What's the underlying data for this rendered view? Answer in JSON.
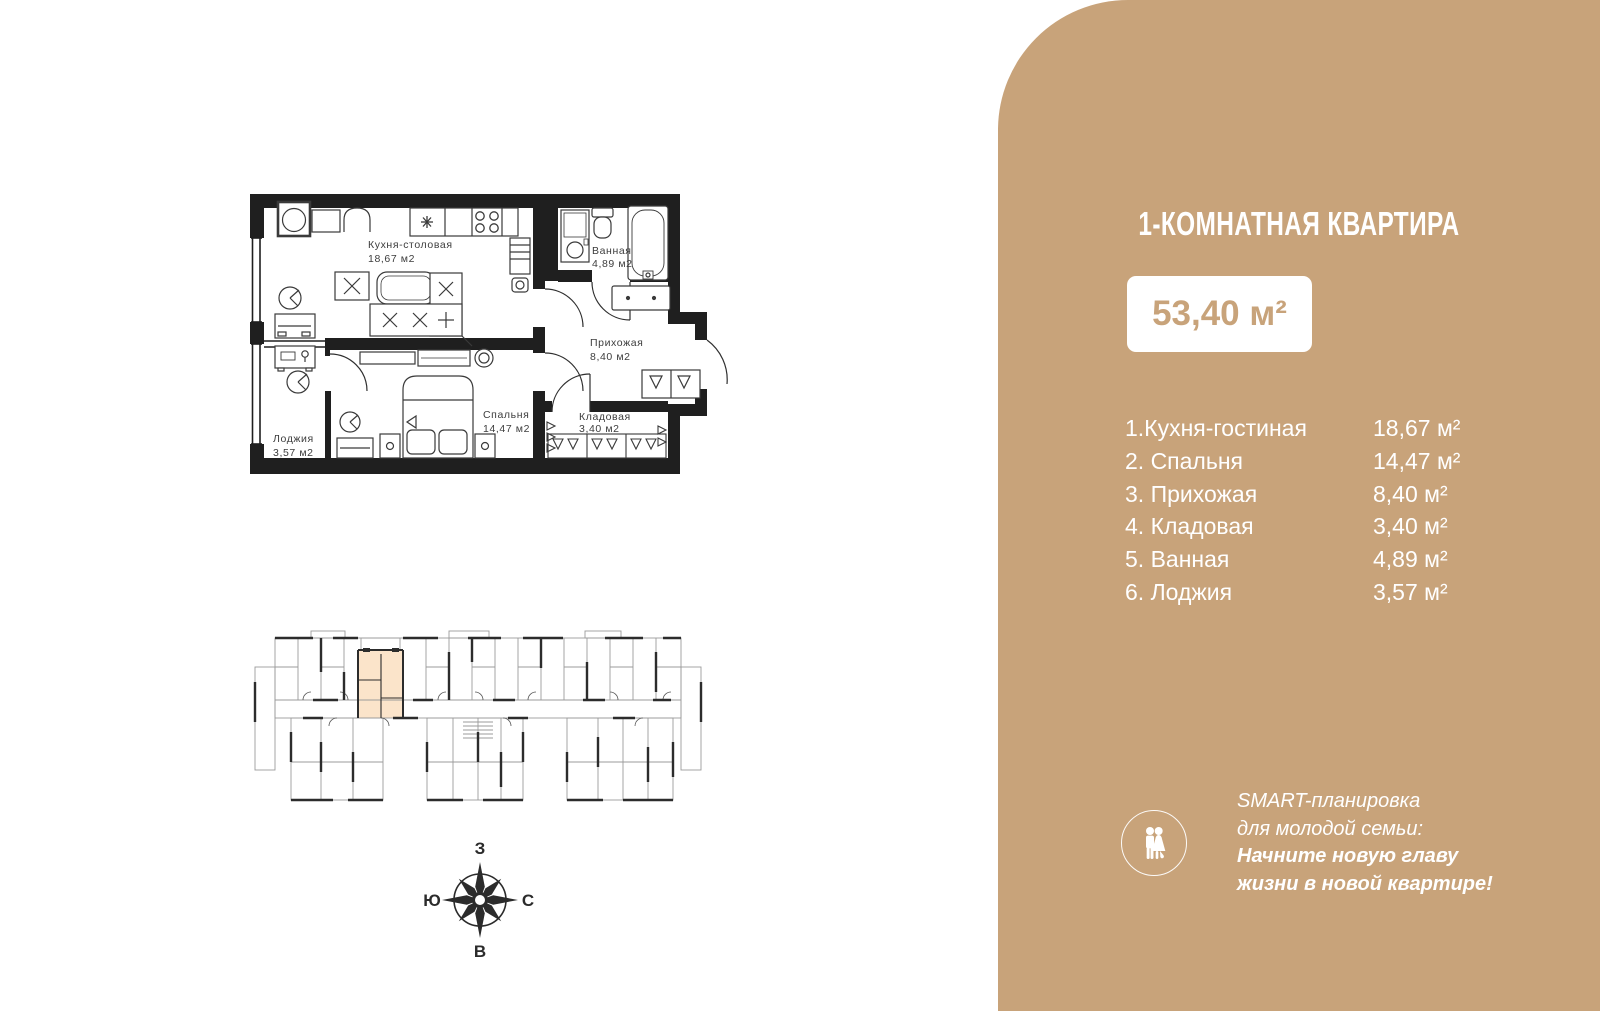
{
  "panel": {
    "title": "1-КОМНАТНАЯ КВАРТИРА",
    "total_area": "53,40 м²",
    "room_list": [
      {
        "label": "1.Кухня-гостиная",
        "area": "18,67 м²"
      },
      {
        "label": "2. Спальня",
        "area": "14,47 м²"
      },
      {
        "label": "3. Прихожая",
        "area": "8,40 м²"
      },
      {
        "label": "4. Кладовая",
        "area": "3,40 м²"
      },
      {
        "label": "5. Ванная",
        "area": "4,89 м²"
      },
      {
        "label": "6. Лоджия",
        "area": "3,57 м²"
      }
    ],
    "smart": {
      "line1": "SMART-планировка",
      "line2": "для молодой семьи:",
      "line3": "Начните новую главу",
      "line4": "жизни в новой квартире!"
    },
    "colors": {
      "panel_bg": "#c8a37a",
      "badge_bg": "#ffffff",
      "badge_text": "#c8a37a",
      "text": "#ffffff"
    }
  },
  "apartment_plan": {
    "rooms": [
      {
        "name": "Кухня-столовая",
        "area": "18,67 м2"
      },
      {
        "name": "Ванная",
        "area": "4,89 м2"
      },
      {
        "name": "Прихожая",
        "area": "8,40 м2"
      },
      {
        "name": "Спальня",
        "area": "14,47 м2"
      },
      {
        "name": "Кладовая",
        "area": "3,40 м2"
      },
      {
        "name": "Лоджия",
        "area": "3,57 м2"
      }
    ]
  },
  "building_plan": {
    "highlight_color": "#fbe4ca"
  },
  "compass": {
    "top": "З",
    "bottom": "В",
    "left": "Ю",
    "right": "С"
  }
}
